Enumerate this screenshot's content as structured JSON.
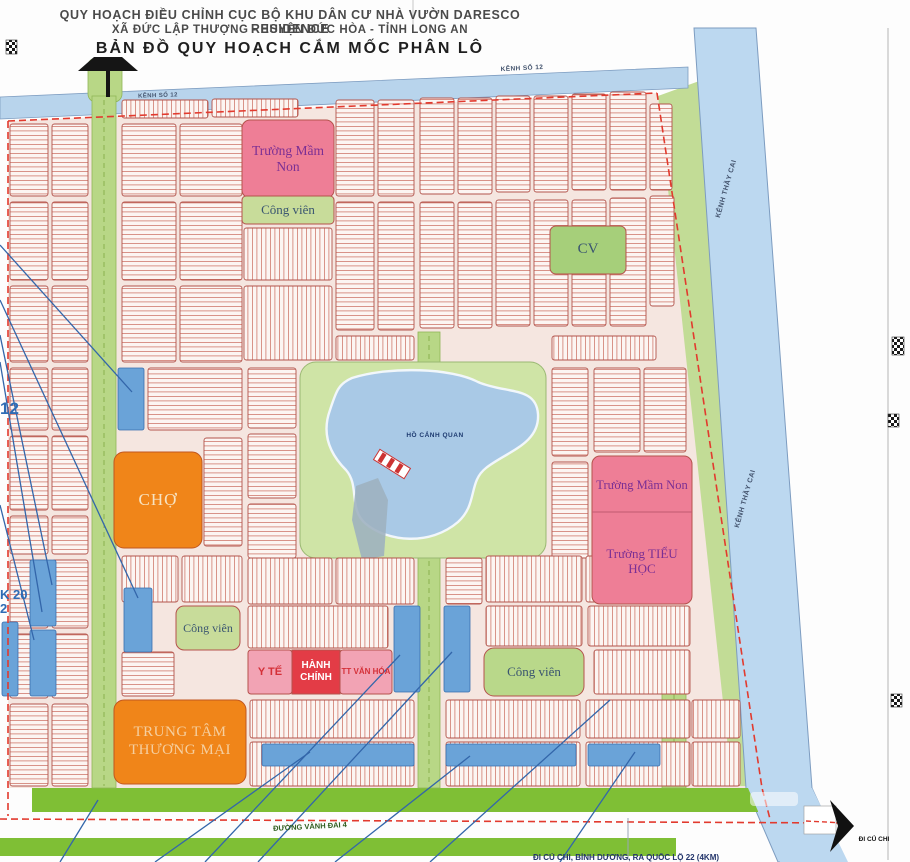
{
  "header": {
    "line1": "QUY HOẠCH ĐIỀU CHỈNH CỤC BỘ KHU DÂN CƯ NHÀ VƯỜN DARESCO RESIDENCE",
    "line2": "XÃ ĐỨC LẬP THƯỢNG - HUYỆN ĐỨC HÒA - TỈNH LONG AN",
    "line3": "BẢN ĐỒ QUY HOẠCH CẮM MỐC PHÂN LÔ"
  },
  "waterways": {
    "top_canal_label_left": "KÊNH SỐ 12",
    "top_canal_label_right": "KÊNH SỐ 12",
    "right_canal_label_upper": "KÊNH THẦY CAI",
    "right_canal_label_lower": "KÊNH THẦY CAI",
    "lake_label": "HỒ CẢNH QUAN"
  },
  "facilities": {
    "kindergarten_top": "Trường Mầm Non",
    "park_top": "Công viên",
    "park_small": "CV",
    "market": "CHỢ",
    "kindergarten_east": "Trường Mầm Non",
    "primary_school": "Trường TIỂU HỌC",
    "park_mid_west": "Công viên",
    "medical": "Y TẾ",
    "administration": "HÀNH CHÍNH",
    "culture_center": "TT VĂN HÓA",
    "park_mid_east": "Công viên",
    "trade_center": "TRUNG TÂM THƯƠNG MẠI"
  },
  "roads": {
    "ring_road": "ĐƯỜNG VÀNH ĐAI 4",
    "direction_east": "ĐI CỦ CHI",
    "bottom_note": "ĐI CỦ CHI, BÌNH DƯƠNG, RA QUỐC LỘ 22 (4KM)"
  },
  "edge_annotations": {
    "west_fragment_1": "12",
    "west_fragment_2": "K 20",
    "west_fragment_3": "2"
  },
  "icons": {
    "water_tower": "black water-tower silhouette",
    "direction_arrow": "solid black right arrow",
    "survey_marker": "checkered grid square"
  },
  "colors": {
    "boundary_red": "#e23a2e",
    "lot_line_red": "#c9685e",
    "facility_pink": "#ee7e96",
    "facility_orange": "#f08519",
    "admin_red": "#e33c46",
    "park_green": "#cfe4a6",
    "road_green": "#b8d786",
    "buffer_green": "#7fbf35",
    "water_blue": "#bcd8f0",
    "highlight_blue": "#6aa3d8",
    "callout_blue": "#3366aa",
    "label_purple": "#7b2f94"
  }
}
